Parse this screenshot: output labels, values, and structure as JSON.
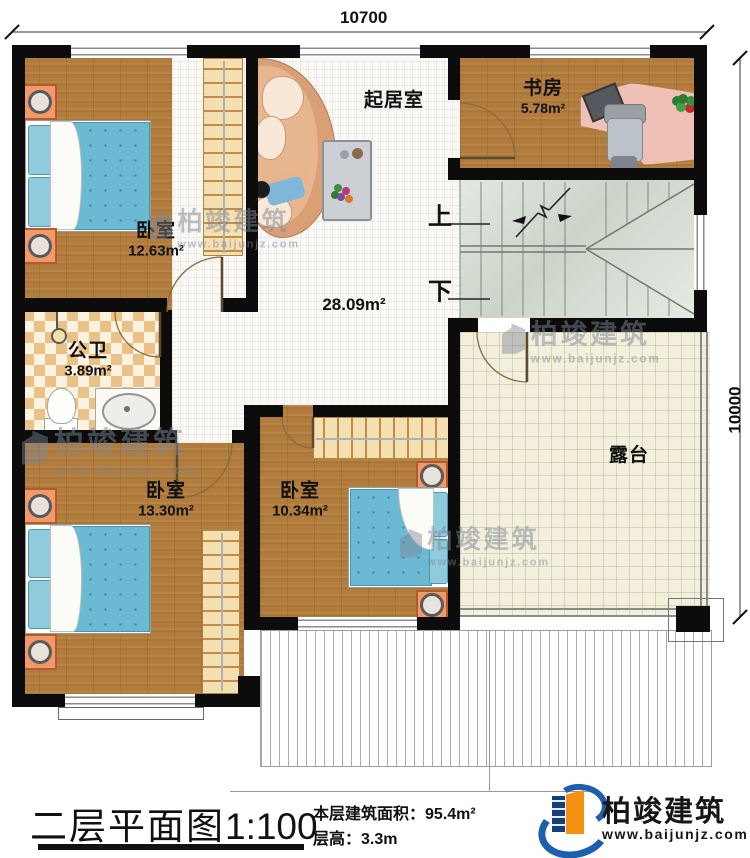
{
  "dimensions": {
    "top": "10700",
    "right": "10000"
  },
  "rooms": {
    "bedroom_tl": {
      "name": "卧室",
      "area": "12.63m²"
    },
    "living": {
      "name": "起居室",
      "area": "28.09m²"
    },
    "study": {
      "name": "书房",
      "area": "5.78m²"
    },
    "bathroom": {
      "name": "公卫",
      "area": "3.89m²"
    },
    "bedroom_bl": {
      "name": "卧室",
      "area": "13.30m²"
    },
    "bedroom_bm": {
      "name": "卧室",
      "area": "10.34m²"
    },
    "terrace": {
      "name": "露台"
    }
  },
  "stairs": {
    "up_label": "上",
    "down_label": "下"
  },
  "title_block": {
    "title": "二层平面图",
    "scale": "1:100",
    "area_label": "本层建筑面积：",
    "area_value": "95.4m²",
    "height_label": "层高：",
    "height_value": "3.3m"
  },
  "brand": {
    "name": "柏竣建筑",
    "website": "www.baijunjz.com"
  },
  "watermark": {
    "name": "柏竣建筑",
    "website": "www.baijunjz.com"
  }
}
